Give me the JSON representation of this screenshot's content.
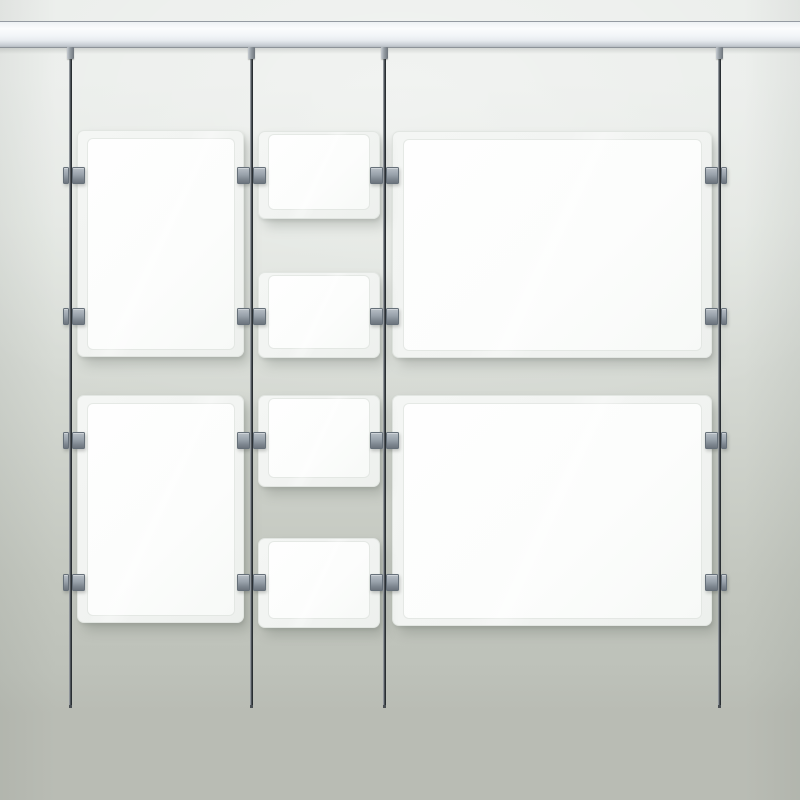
{
  "scene": {
    "kind": "cable-suspended-poster-display-render",
    "canvas": {
      "width": 800,
      "height": 800
    }
  },
  "colors": {
    "bg_top": "#e9ece9",
    "bg_mid": "#d7dbd5",
    "bg_low": "#c3c7bf",
    "bg_bottom": "#b9bcb4",
    "rail_light": "#fbfcfd",
    "rail_body": "#e7ebef",
    "rail_dark": "#c6ccd2",
    "rail_line": "#959ba2",
    "cable_light": "#b6bbbf",
    "cable_dark": "#2d3237",
    "clamp_face": "#99a2ab",
    "clamp_light": "#b7bec5",
    "clamp_dark": "#6d757e",
    "panel_outer": "#f1f3f1",
    "panel_inner": "#fcfdfc",
    "panel_edge": "#e2e6e2",
    "shadow_soft": "rgba(95,100,94,0.28)"
  },
  "layout": {
    "rail": {
      "x": 0,
      "y": 21,
      "width": 800,
      "height": 27
    },
    "cable_top": 47,
    "cable_bottom": 708,
    "clamp_rows": [
      167,
      308,
      432,
      574
    ],
    "clamp_height": 17,
    "cables": [
      {
        "x": 70.5,
        "clamp_left_w": 6,
        "clamp_right_w": 13
      },
      {
        "x": 251.5,
        "clamp_left_w": 13,
        "clamp_right_w": 13
      },
      {
        "x": 384.5,
        "clamp_left_w": 13,
        "clamp_right_w": 13
      },
      {
        "x": 719.5,
        "clamp_left_w": 13,
        "clamp_right_w": 6
      }
    ],
    "panels": [
      {
        "id": "left-top",
        "type": "portrait",
        "x": 77,
        "y": 130,
        "w": 167,
        "h": 227,
        "inset": {
          "l": 10,
          "r": 9,
          "t": 8,
          "b": 7
        }
      },
      {
        "id": "left-bottom",
        "type": "portrait",
        "x": 77,
        "y": 395,
        "w": 167,
        "h": 228,
        "inset": {
          "l": 10,
          "r": 9,
          "t": 8,
          "b": 7
        }
      },
      {
        "id": "right-top",
        "type": "landscape",
        "x": 392,
        "y": 131,
        "w": 320,
        "h": 227,
        "inset": {
          "l": 11,
          "r": 10,
          "t": 8,
          "b": 7
        }
      },
      {
        "id": "right-bottom",
        "type": "landscape",
        "x": 392,
        "y": 395,
        "w": 320,
        "h": 231,
        "inset": {
          "l": 11,
          "r": 10,
          "t": 8,
          "b": 7
        }
      },
      {
        "id": "middle-1",
        "type": "small",
        "x": 258,
        "y": 131,
        "w": 122,
        "h": 88,
        "inset": {
          "l": 10,
          "r": 10,
          "t": 3,
          "b": 9
        }
      },
      {
        "id": "middle-2",
        "type": "small",
        "x": 258,
        "y": 272,
        "w": 122,
        "h": 86,
        "inset": {
          "l": 10,
          "r": 10,
          "t": 3,
          "b": 9
        }
      },
      {
        "id": "middle-3",
        "type": "small",
        "x": 258,
        "y": 395,
        "w": 122,
        "h": 92,
        "inset": {
          "l": 10,
          "r": 10,
          "t": 3,
          "b": 9
        }
      },
      {
        "id": "middle-4",
        "type": "small",
        "x": 258,
        "y": 538,
        "w": 122,
        "h": 90,
        "inset": {
          "l": 10,
          "r": 10,
          "t": 3,
          "b": 9
        }
      }
    ]
  }
}
